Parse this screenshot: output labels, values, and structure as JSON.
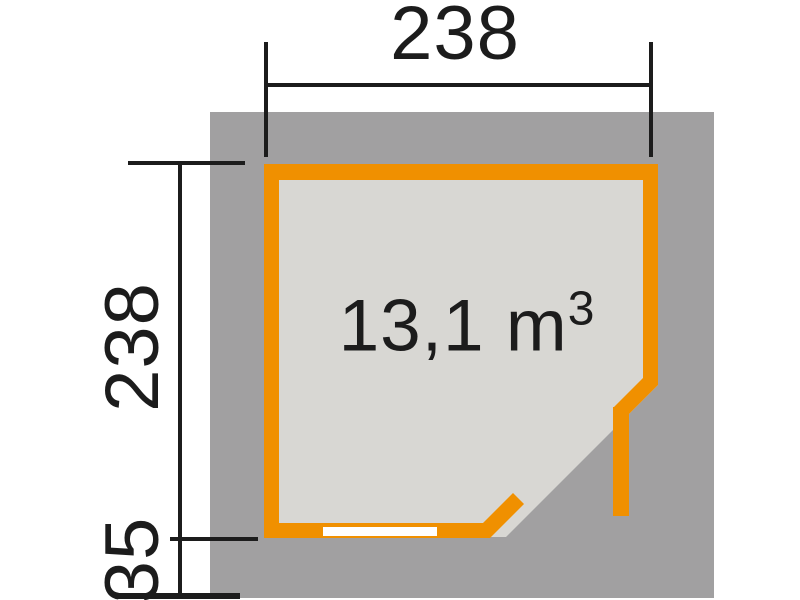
{
  "diagram": {
    "volume": {
      "text": "13,1 m",
      "exponent": "3"
    },
    "dimensions": {
      "width": "238",
      "depth": "238",
      "overhang": "35"
    },
    "colors": {
      "wall": "#F09000",
      "roof": "#A1A0A1",
      "floor": "#D8D7D3",
      "line": "#1C1C1C",
      "window": "#FFFFFF"
    }
  }
}
